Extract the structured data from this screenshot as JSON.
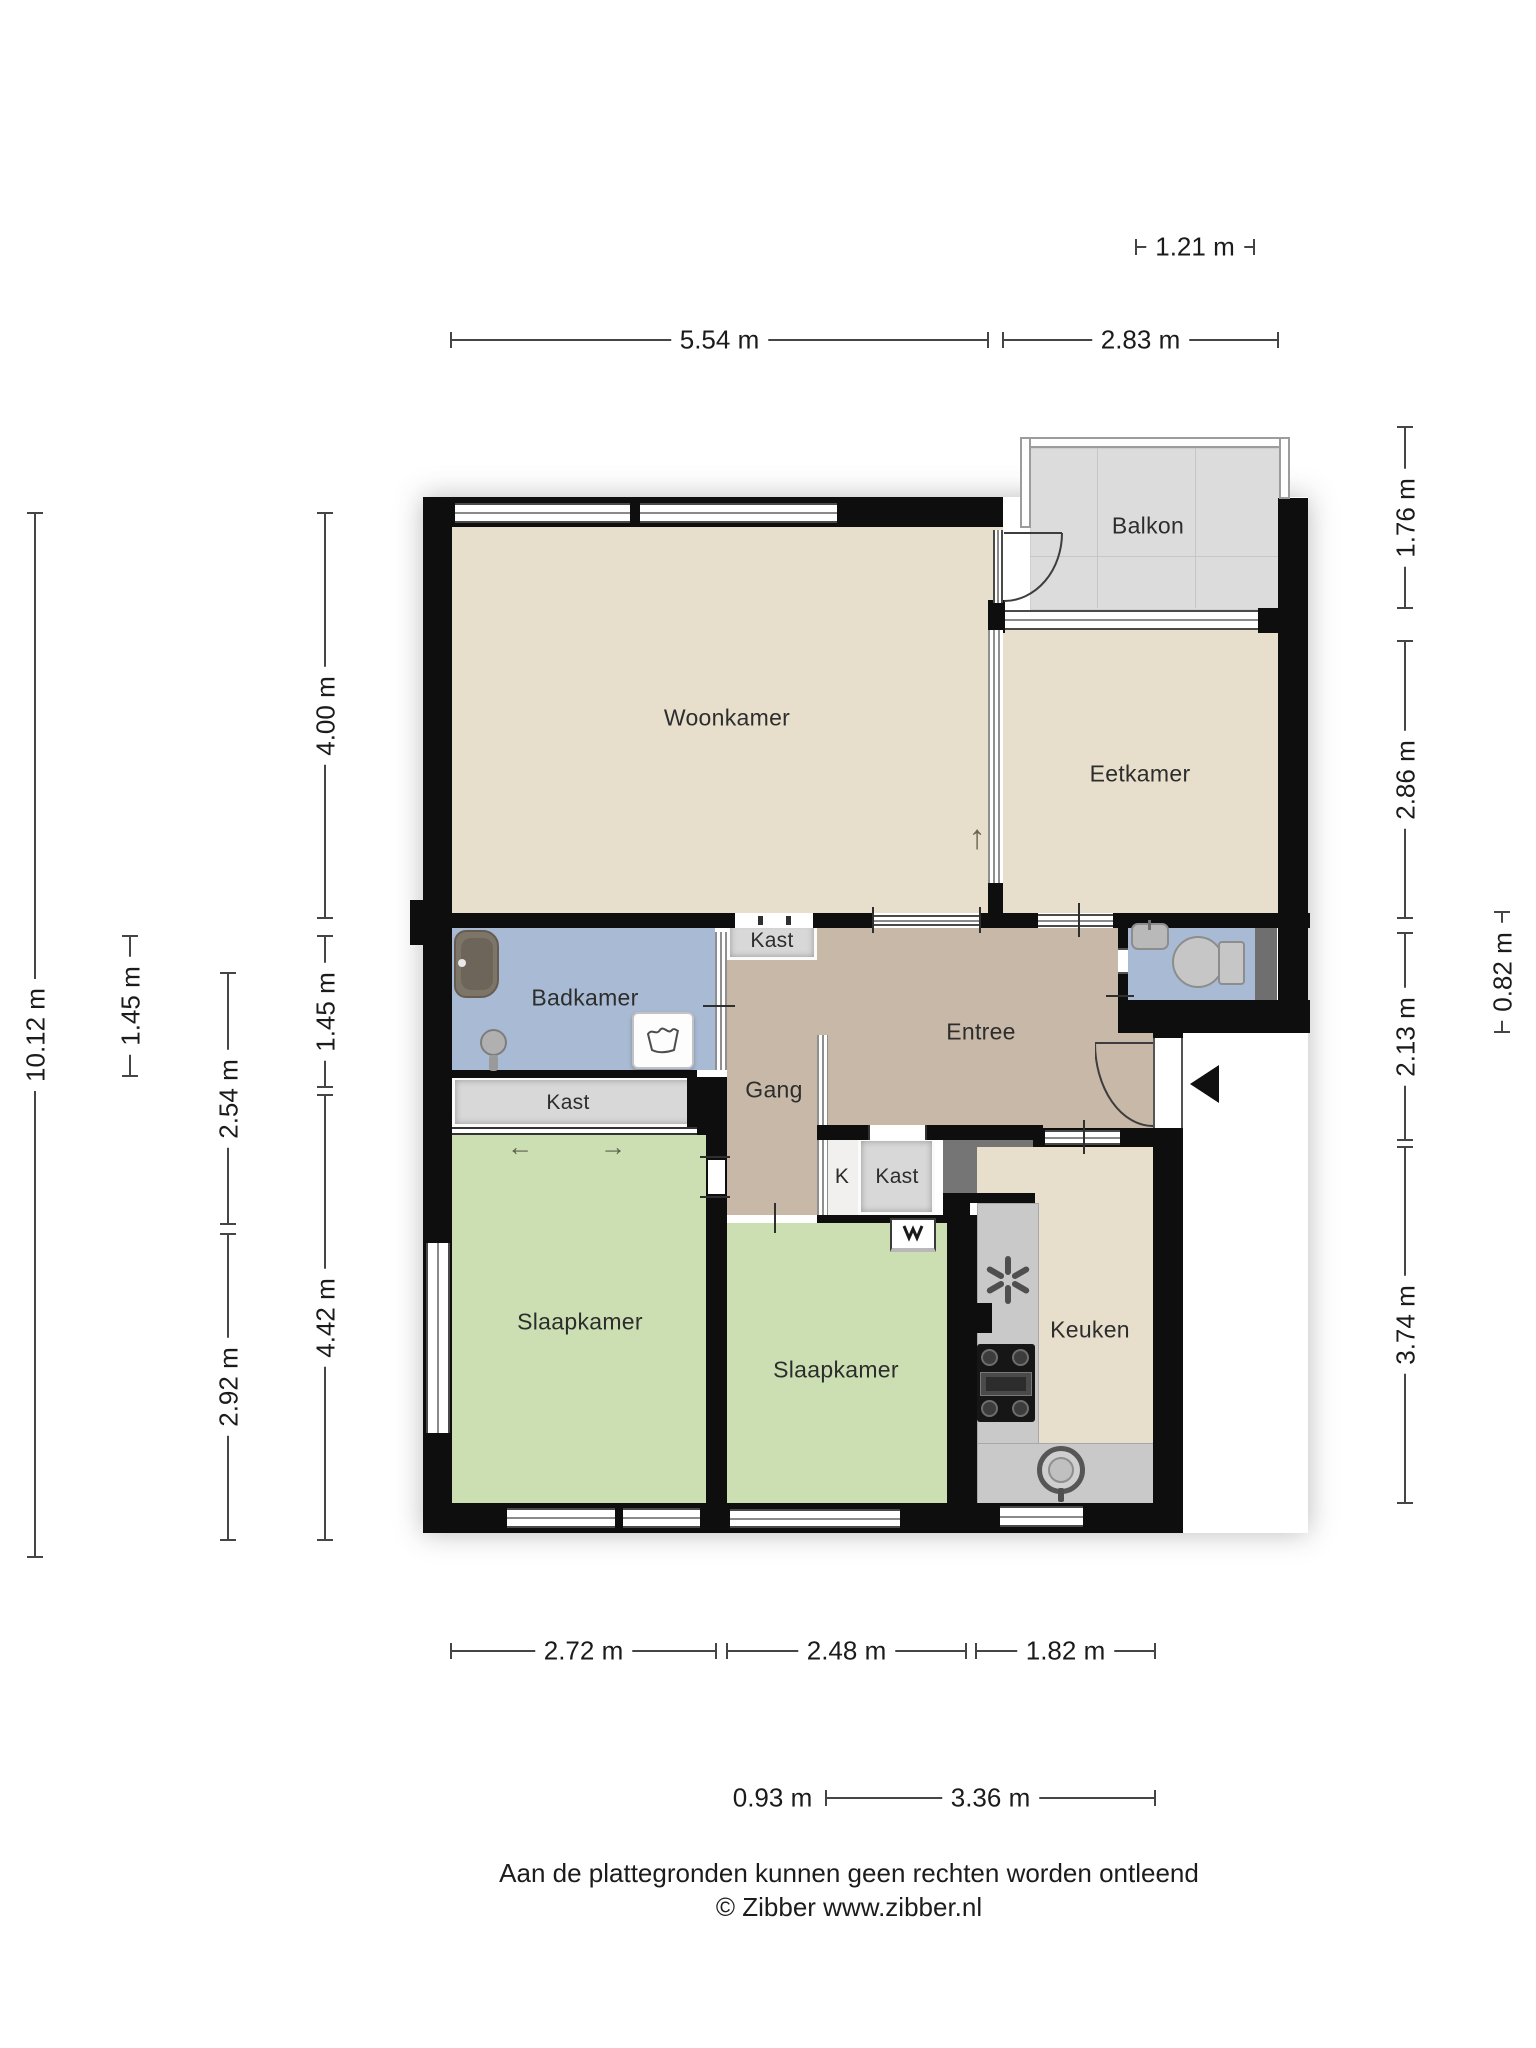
{
  "title": "Floor plan (plattegrond)",
  "rooms": {
    "woonkamer": "Woonkamer",
    "eetkamer": "Eetkamer",
    "balkon": "Balkon",
    "badkamer": "Badkamer",
    "entree": "Entree",
    "gang": "Gang",
    "keuken": "Keuken",
    "slaapkamer1": "Slaapkamer",
    "slaapkamer2": "Slaapkamer",
    "kast_woonkamer": "Kast",
    "kast_badkamer": "Kast",
    "kast_hal": "Kast",
    "k": "K"
  },
  "dimensions": {
    "top": [
      "1.21 m",
      "5.54 m",
      "2.83 m"
    ],
    "bottom": [
      "2.72 m",
      "2.48 m",
      "1.82 m",
      "0.93 m",
      "3.36 m"
    ],
    "left": [
      "10.12 m",
      "1.45 m",
      "2.54 m",
      "2.92 m",
      "4.00 m",
      "1.45 m",
      "4.42 m"
    ],
    "right": [
      "1.76 m",
      "2.86 m",
      "2.13 m",
      "3.74 m",
      "0.82 m"
    ]
  },
  "icons": {
    "slide_left_arrow": "←",
    "slide_right_arrow": "→",
    "up_arrow": "↑"
  },
  "colors": {
    "wall": "#0e0e0e",
    "floor_living": "#e7dfcc",
    "floor_bath": "#a9bbd4",
    "floor_bedroom": "#cbdfb2",
    "floor_hall": "#c7b8a8",
    "floor_balcony": "#dcdcdc",
    "closet": "#d8d8d8",
    "shaft": "#757575",
    "counter": "#c9c9c9"
  },
  "footer": {
    "line1": "Aan de plattegronden kunnen geen rechten worden ontleend",
    "line2": "© Zibber www.zibber.nl"
  }
}
